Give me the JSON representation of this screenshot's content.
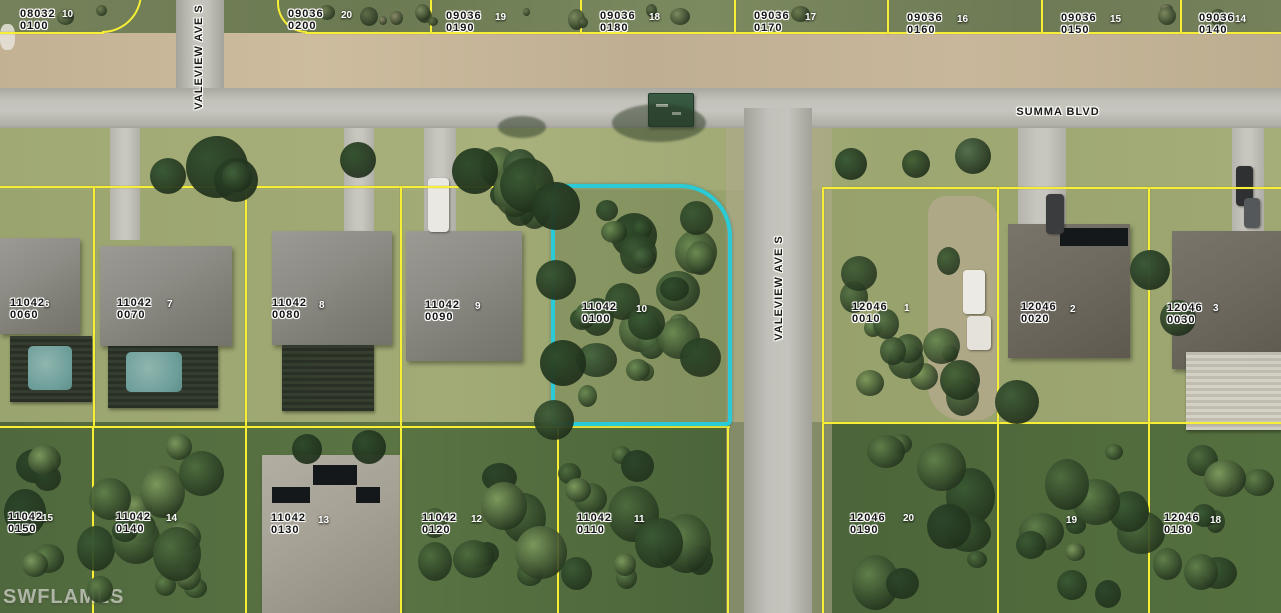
{
  "map": {
    "watermark": "SWFLAMLS",
    "colors": {
      "highlight": "#2acbd6",
      "parcel_line": "#f7ee37",
      "label_text": "#141414",
      "lot_number_text": "#ffffff"
    },
    "streets": [
      {
        "name": "VALEVIEW AVE S",
        "orientation": "vertical",
        "cx": 199,
        "cy": 57
      },
      {
        "name": "SUMMA BLVD",
        "orientation": "horizontal",
        "cx": 1058,
        "cy": 112
      },
      {
        "name": "VALEVIEW AVE S",
        "orientation": "vertical",
        "cx": 779,
        "cy": 288
      }
    ],
    "highlighted_parcel": {
      "block": "11042",
      "lot_id": "0100",
      "lot_number": "10"
    },
    "parcels": [
      {
        "block": "08032",
        "lot_id": "0100",
        "lot_number": "10",
        "x": 20,
        "y": 8,
        "nx": 62,
        "ny": 10,
        "highlighted": false
      },
      {
        "block": "09036",
        "lot_id": "0200",
        "lot_number": "20",
        "x": 288,
        "y": 8,
        "nx": 341,
        "ny": 11,
        "highlighted": false
      },
      {
        "block": "09036",
        "lot_id": "0190",
        "lot_number": "19",
        "x": 446,
        "y": 10,
        "nx": 495,
        "ny": 13,
        "highlighted": false
      },
      {
        "block": "09036",
        "lot_id": "0180",
        "lot_number": "18",
        "x": 600,
        "y": 10,
        "nx": 649,
        "ny": 13,
        "highlighted": false
      },
      {
        "block": "09036",
        "lot_id": "0170",
        "lot_number": "17",
        "x": 754,
        "y": 10,
        "nx": 805,
        "ny": 13,
        "highlighted": false
      },
      {
        "block": "09036",
        "lot_id": "0160",
        "lot_number": "16",
        "x": 907,
        "y": 12,
        "nx": 957,
        "ny": 15,
        "highlighted": false
      },
      {
        "block": "09036",
        "lot_id": "0150",
        "lot_number": "15",
        "x": 1061,
        "y": 12,
        "nx": 1110,
        "ny": 15,
        "highlighted": false
      },
      {
        "block": "09036",
        "lot_id": "0140",
        "lot_number": "14",
        "x": 1199,
        "y": 12,
        "nx": 1235,
        "ny": 15,
        "highlighted": false
      },
      {
        "block": "11042",
        "lot_id": "0060",
        "lot_number": "6",
        "x": 10,
        "y": 297,
        "nx": 44,
        "ny": 300,
        "highlighted": false
      },
      {
        "block": "11042",
        "lot_id": "0070",
        "lot_number": "7",
        "x": 117,
        "y": 297,
        "nx": 167,
        "ny": 300,
        "highlighted": false
      },
      {
        "block": "11042",
        "lot_id": "0080",
        "lot_number": "8",
        "x": 272,
        "y": 297,
        "nx": 319,
        "ny": 301,
        "highlighted": false
      },
      {
        "block": "11042",
        "lot_id": "0090",
        "lot_number": "9",
        "x": 425,
        "y": 299,
        "nx": 475,
        "ny": 302,
        "highlighted": false
      },
      {
        "block": "11042",
        "lot_id": "0100",
        "lot_number": "10",
        "x": 582,
        "y": 301,
        "nx": 636,
        "ny": 305,
        "highlighted": true
      },
      {
        "block": "12046",
        "lot_id": "0010",
        "lot_number": "1",
        "x": 852,
        "y": 301,
        "nx": 904,
        "ny": 304,
        "highlighted": false
      },
      {
        "block": "12046",
        "lot_id": "0020",
        "lot_number": "2",
        "x": 1021,
        "y": 301,
        "nx": 1070,
        "ny": 305,
        "highlighted": false
      },
      {
        "block": "12046",
        "lot_id": "0030",
        "lot_number": "3",
        "x": 1167,
        "y": 302,
        "nx": 1213,
        "ny": 304,
        "highlighted": false
      },
      {
        "block": "11042",
        "lot_id": "0150",
        "lot_number": "15",
        "x": 8,
        "y": 511,
        "nx": 42,
        "ny": 514,
        "highlighted": false
      },
      {
        "block": "11042",
        "lot_id": "0140",
        "lot_number": "14",
        "x": 116,
        "y": 511,
        "nx": 166,
        "ny": 514,
        "highlighted": false
      },
      {
        "block": "11042",
        "lot_id": "0130",
        "lot_number": "13",
        "x": 271,
        "y": 512,
        "nx": 318,
        "ny": 516,
        "highlighted": false
      },
      {
        "block": "11042",
        "lot_id": "0120",
        "lot_number": "12",
        "x": 422,
        "y": 512,
        "nx": 471,
        "ny": 515,
        "highlighted": false
      },
      {
        "block": "11042",
        "lot_id": "0110",
        "lot_number": "11",
        "x": 577,
        "y": 512,
        "nx": 634,
        "ny": 515,
        "highlighted": false
      },
      {
        "block": "12046",
        "lot_id": "0190",
        "lot_number": "20",
        "x": 850,
        "y": 512,
        "nx": 903,
        "ny": 514,
        "highlighted": false
      },
      {
        "block": "",
        "lot_id": "",
        "lot_number": "19",
        "x": 0,
        "y": 0,
        "nx": 1066,
        "ny": 516,
        "highlighted": false
      },
      {
        "block": "12046",
        "lot_id": "0180",
        "lot_number": "18",
        "x": 1164,
        "y": 512,
        "nx": 1210,
        "ny": 516,
        "highlighted": false
      }
    ]
  }
}
